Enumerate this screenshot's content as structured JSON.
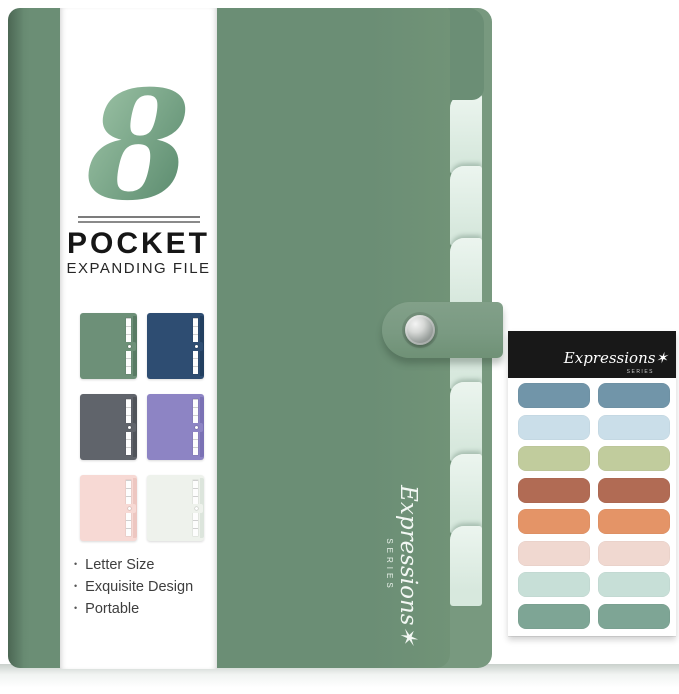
{
  "product": {
    "pocket_count": "8",
    "title": "POCKET",
    "subtitle": "EXPANDING FILE",
    "features": [
      "Letter Size",
      "Exquisite Design",
      "Portable"
    ],
    "brand_script": "Expressions",
    "brand_series": "SERIES"
  },
  "icons": {
    "star": "✶"
  },
  "swatches": [
    {
      "name": "sage-green",
      "body": "#6d9078",
      "edge": "#597b64"
    },
    {
      "name": "navy-blue",
      "body": "#2e4d72",
      "edge": "#223f60"
    },
    {
      "name": "slate-gray",
      "body": "#60646b",
      "edge": "#50545a"
    },
    {
      "name": "lavender-purple",
      "body": "#8d84c4",
      "edge": "#7a71b4"
    },
    {
      "name": "blush-pink",
      "body": "#f7d9d4",
      "edge": "#edc7c1"
    },
    {
      "name": "ivory-mint",
      "body": "#eef2ec",
      "edge": "#dce5dc"
    }
  ],
  "sticker_sheet": {
    "brand_script": "Expressions",
    "brand_series": "SERIES",
    "header_color": "#181818",
    "rows": [
      {
        "name": "steel-blue",
        "color": "#7195a9"
      },
      {
        "name": "powder-blue",
        "color": "#cadee9"
      },
      {
        "name": "sage-olive",
        "color": "#c1cc9d"
      },
      {
        "name": "terracotta",
        "color": "#b16b54"
      },
      {
        "name": "salmon",
        "color": "#e49467"
      },
      {
        "name": "blush",
        "color": "#f0d8d0"
      },
      {
        "name": "pale-mint",
        "color": "#c7dfd7"
      },
      {
        "name": "sea-green",
        "color": "#7ea595"
      }
    ]
  },
  "folder": {
    "front_color": "#6b8e75",
    "back_color": "#78997f",
    "tab_color": "#dfeee5",
    "strap_color": "#7a9a82",
    "logo_gradient": [
      "#a6cbae",
      "#4f8164"
    ],
    "mint_tab_count": 7
  }
}
